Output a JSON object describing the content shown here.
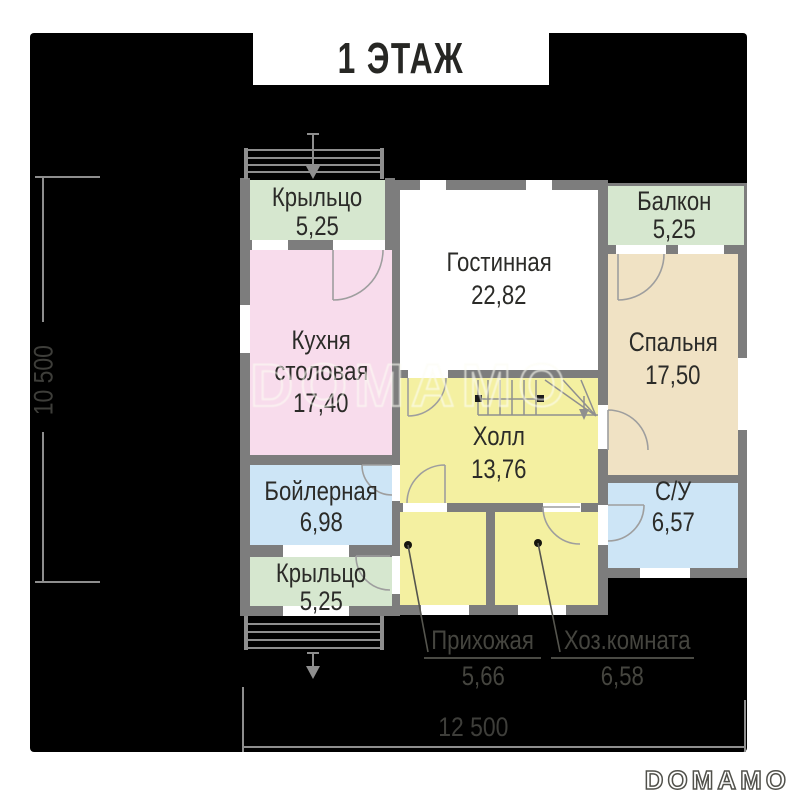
{
  "title": "1 ЭТАЖ",
  "watermark": {
    "plan_text": "DOMAMO",
    "logo_text": "DOMAMO"
  },
  "dimensions": {
    "height_label": "10 500",
    "width_label": "12 500"
  },
  "rooms": {
    "porch_top": {
      "name": "Крыльцо",
      "area": "5,25"
    },
    "living": {
      "name": "Гостинная",
      "area": "22,82"
    },
    "balcony": {
      "name": "Балкон",
      "area": "5,25"
    },
    "kitchen": {
      "name1": "Кухня",
      "name2": "столовая",
      "area": "17,40"
    },
    "bedroom": {
      "name": "Спальня",
      "area": "17,50"
    },
    "hall": {
      "name": "Холл",
      "area": "13,76"
    },
    "boiler": {
      "name": "Бойлерная",
      "area": "6,98"
    },
    "wc": {
      "name": "С/У",
      "area": "6,57"
    },
    "porch_bottom": {
      "name": "Крыльцо",
      "area": "5,25"
    },
    "entry": {
      "name": "Прихожая",
      "area": "5,66"
    },
    "utility": {
      "name": "Хоз.комната",
      "area": "6,58"
    }
  },
  "colors": {
    "c-green": "#d6e7cf",
    "c-pink": "#f8dcec",
    "c-beige": "#f0e2c4",
    "c-yellow": "#f4f0a1",
    "c-blue": "#cde5f6",
    "c-wall": "#7d7d7d",
    "c-ink": "#2b2b28",
    "c-line": "#8e8e8e",
    "c-black": "#000000"
  }
}
